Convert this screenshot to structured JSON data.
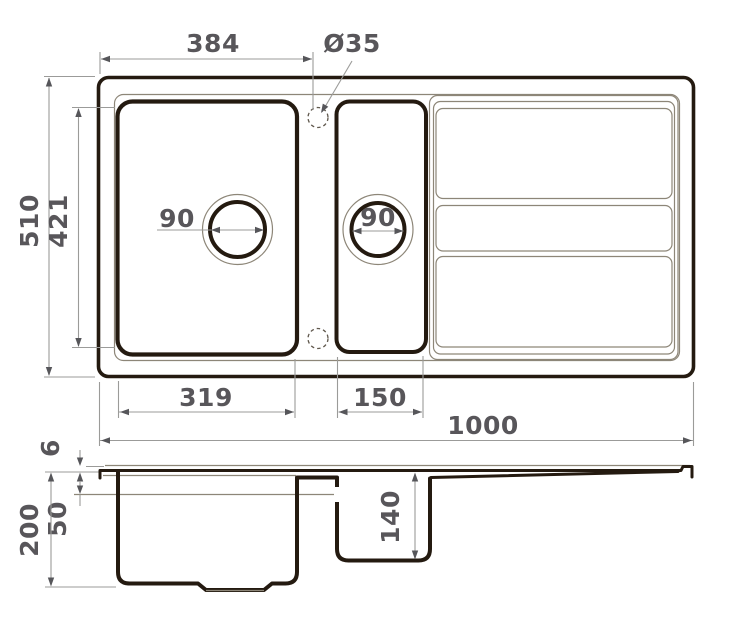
{
  "drawing_title": "sink-dimension-drawing",
  "top_view": {
    "hole_offset": "384",
    "hole_diameter": "Ø35",
    "outer_depth": "510",
    "bowl_inner_depth": "421",
    "main_drain_diameter": "90",
    "half_drain_diameter": "90",
    "main_bowl_width": "319",
    "half_bowl_width": "150",
    "total_width": "1000"
  },
  "section_view": {
    "rim_height": "6",
    "ledge_depth": "50",
    "total_height": "200",
    "half_bowl_depth": "140"
  },
  "colors": {
    "outline_dark": "#241a10",
    "outline_thin": "#8d8678",
    "dimension_gray": "#9b9b99",
    "label_gray": "#58565a",
    "background": "#ffffff"
  }
}
